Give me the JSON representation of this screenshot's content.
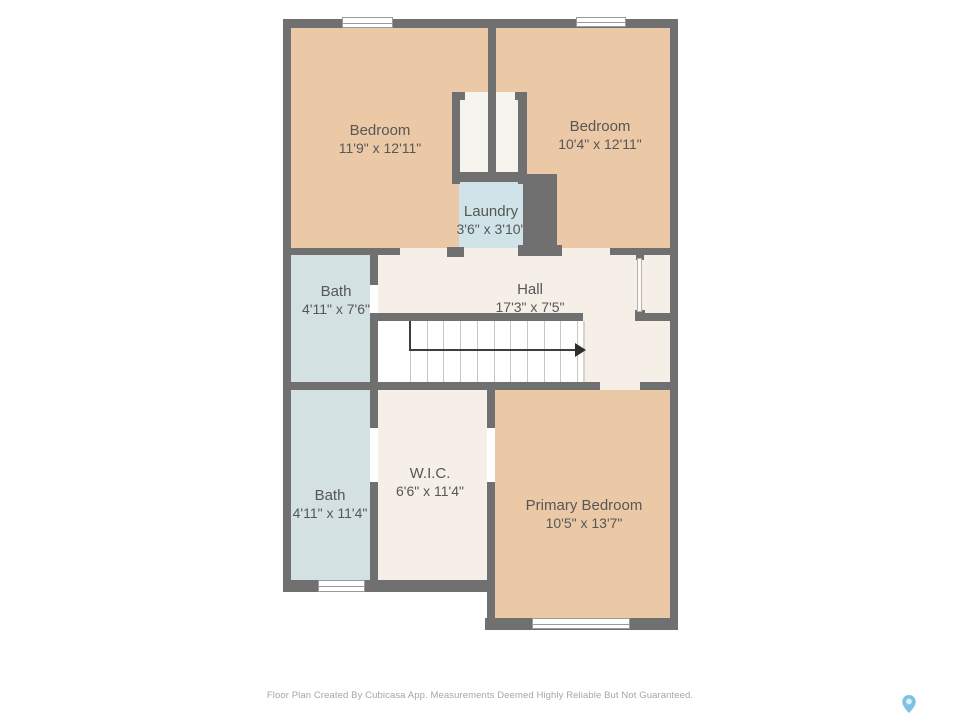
{
  "floor_plan": {
    "rooms": [
      {
        "id": "bedroom-1",
        "name": "Bedroom",
        "dims": "11'9\" x 12'11\""
      },
      {
        "id": "bedroom-2",
        "name": "Bedroom",
        "dims": "10'4\" x 12'11\""
      },
      {
        "id": "laundry",
        "name": "Laundry",
        "dims": "3'6\" x 3'10\""
      },
      {
        "id": "bath-upper",
        "name": "Bath",
        "dims": "4'11\" x 7'6\""
      },
      {
        "id": "hall",
        "name": "Hall",
        "dims": "17'3\" x 7'5\""
      },
      {
        "id": "bath-lower",
        "name": "Bath",
        "dims": "4'11\" x 11'4\""
      },
      {
        "id": "wic",
        "name": "W.I.C.",
        "dims": "6'6\" x 11'4\""
      },
      {
        "id": "primary-bedroom",
        "name": "Primary Bedroom",
        "dims": "10'5\" x 13'7\""
      }
    ],
    "stairs": {
      "tread_count": 11,
      "arrow_direction": "right"
    },
    "footer": {
      "disclaimer": "Floor Plan Created By Cubicasa App. Measurements Deemed Highly Reliable But Not Guaranteed."
    },
    "branding": {
      "icon": "map-pin-icon",
      "pin_color": "#7ec2e5"
    },
    "colors": {
      "wall": "#707070",
      "bedroom_fill": "#ebc9a6",
      "bath_fill": "#d3e1e3",
      "laundry_fill": "#cfe3e8",
      "hall_fill": "#f6efe7",
      "stairs_fill": "#ffffff",
      "label_text": "#575757",
      "footer_text": "#a6a6a6"
    }
  }
}
